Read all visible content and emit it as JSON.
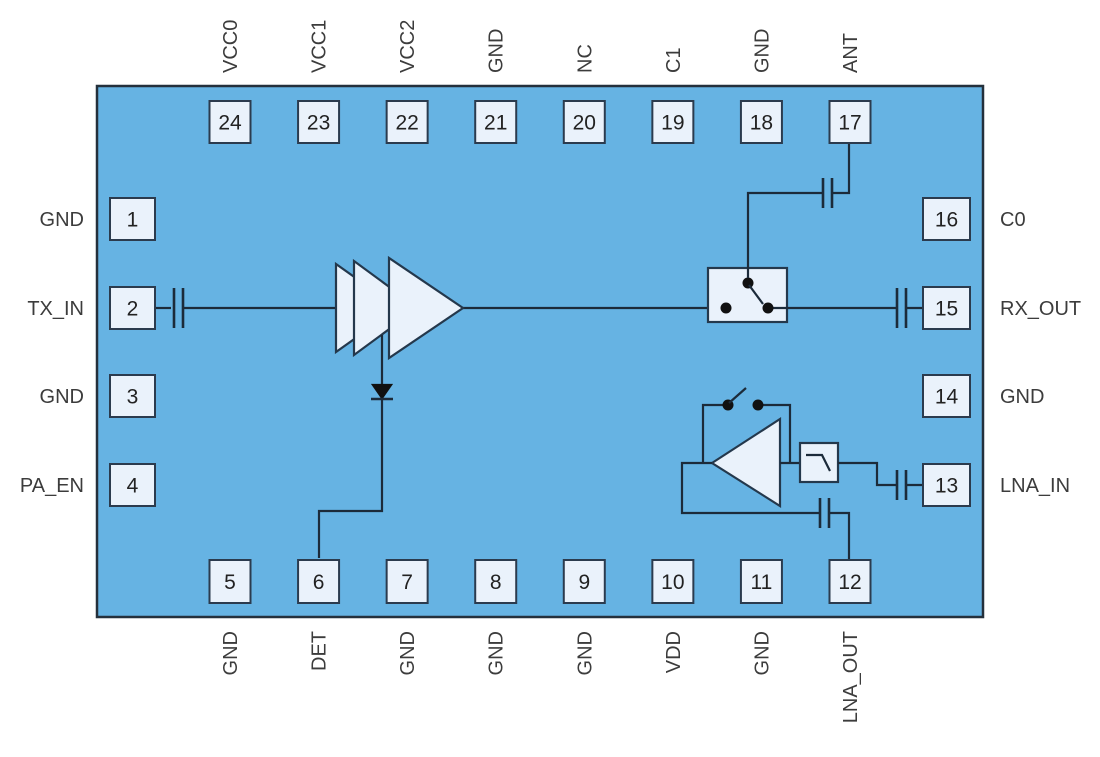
{
  "diagram": {
    "description": "RF front-end module 24-pin functional block diagram",
    "colors": {
      "chip_fill": "#66B3E3",
      "chip_border": "#24303C",
      "pin_fill": "#EAF2FB",
      "pin_border": "#2B3B4E",
      "wire": "#1C2B3A",
      "component_fill": "#EAF2FB",
      "label_text": "#3C3C3C",
      "pin_number_text": "#222222",
      "background": "#FFFFFF"
    },
    "pins": {
      "top": [
        {
          "num": "24",
          "label": "VCC0"
        },
        {
          "num": "23",
          "label": "VCC1"
        },
        {
          "num": "22",
          "label": "VCC2"
        },
        {
          "num": "21",
          "label": "GND"
        },
        {
          "num": "20",
          "label": "NC"
        },
        {
          "num": "19",
          "label": "C1"
        },
        {
          "num": "18",
          "label": "GND"
        },
        {
          "num": "17",
          "label": "ANT"
        }
      ],
      "bottom": [
        {
          "num": "5",
          "label": "GND"
        },
        {
          "num": "6",
          "label": "DET"
        },
        {
          "num": "7",
          "label": "GND"
        },
        {
          "num": "8",
          "label": "GND"
        },
        {
          "num": "9",
          "label": "GND"
        },
        {
          "num": "10",
          "label": "VDD"
        },
        {
          "num": "11",
          "label": "GND"
        },
        {
          "num": "12",
          "label": "LNA_OUT"
        }
      ],
      "left": [
        {
          "num": "1",
          "label": "GND"
        },
        {
          "num": "2",
          "label": "TX_IN"
        },
        {
          "num": "3",
          "label": "GND"
        },
        {
          "num": "4",
          "label": "PA_EN"
        }
      ],
      "right": [
        {
          "num": "16",
          "label": "C0"
        },
        {
          "num": "15",
          "label": "RX_OUT"
        },
        {
          "num": "14",
          "label": "GND"
        },
        {
          "num": "13",
          "label": "LNA_IN"
        }
      ]
    },
    "components": [
      "power-amplifier-chain",
      "detector-diode",
      "tx-rx-switch",
      "lna-amplifier",
      "lna-bypass-switch",
      "low-pass-filter",
      "dc-block-capacitors"
    ]
  }
}
